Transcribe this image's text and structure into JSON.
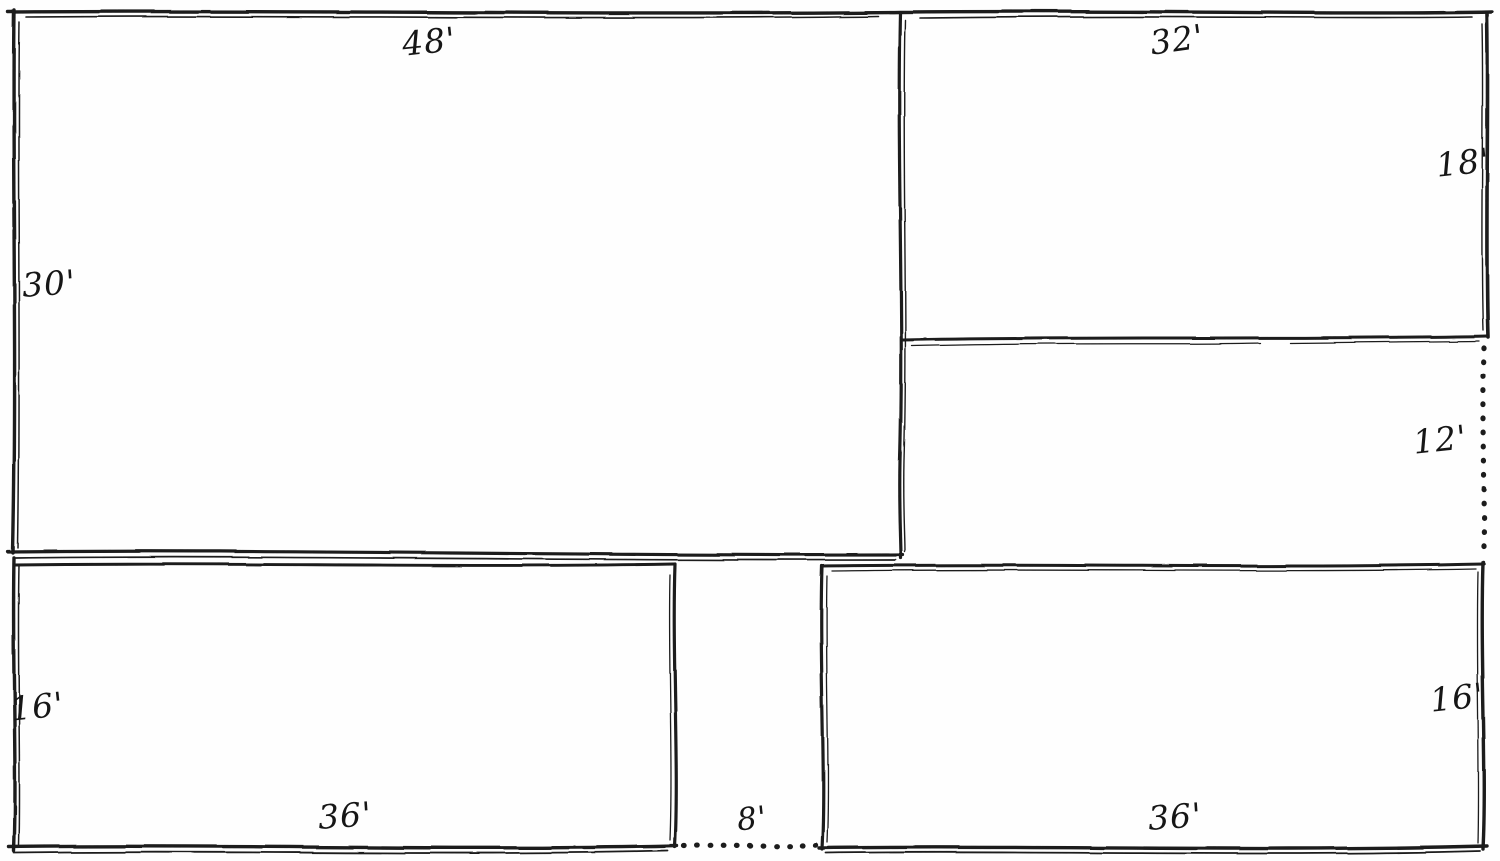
{
  "diagram": {
    "type": "hand-drawn plot plan",
    "description": "Pen-and-ink plan of adjoining rectangular yards with dimensions in feet",
    "ink_color": "#1a1a1a",
    "paper_color": "#fefefe",
    "regions": {
      "top_left": {
        "name": "large upper-left yard",
        "width": "48'",
        "height": "30'"
      },
      "top_right": {
        "name": "upper-right yard",
        "width": "32'",
        "height": "18'"
      },
      "middle_right": {
        "name": "middle-right strip (dotted east boundary)",
        "height": "12'"
      },
      "bottom_left": {
        "name": "lower-left yard",
        "width": "36'",
        "height": "16'"
      },
      "bottom_right": {
        "name": "lower-right yard",
        "width": "36'",
        "height": "16'"
      },
      "gap": {
        "name": "passage between lower yards (dotted south boundary)",
        "width": "8'"
      }
    }
  }
}
